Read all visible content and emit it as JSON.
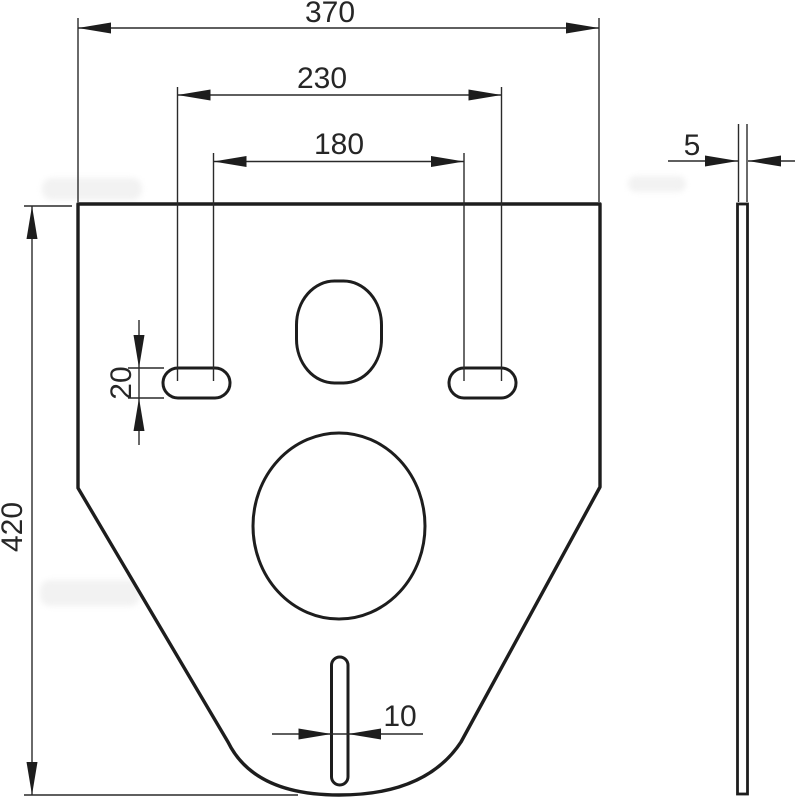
{
  "drawing": {
    "front_view": {
      "dim_overall_width": "370",
      "dim_outer_slot_spacing": "230",
      "dim_inner_slot_spacing": "180",
      "dim_overall_height": "420",
      "dim_slot_height": "20",
      "dim_bottom_slot_width": "10"
    },
    "side_view": {
      "dim_thickness": "5"
    }
  }
}
